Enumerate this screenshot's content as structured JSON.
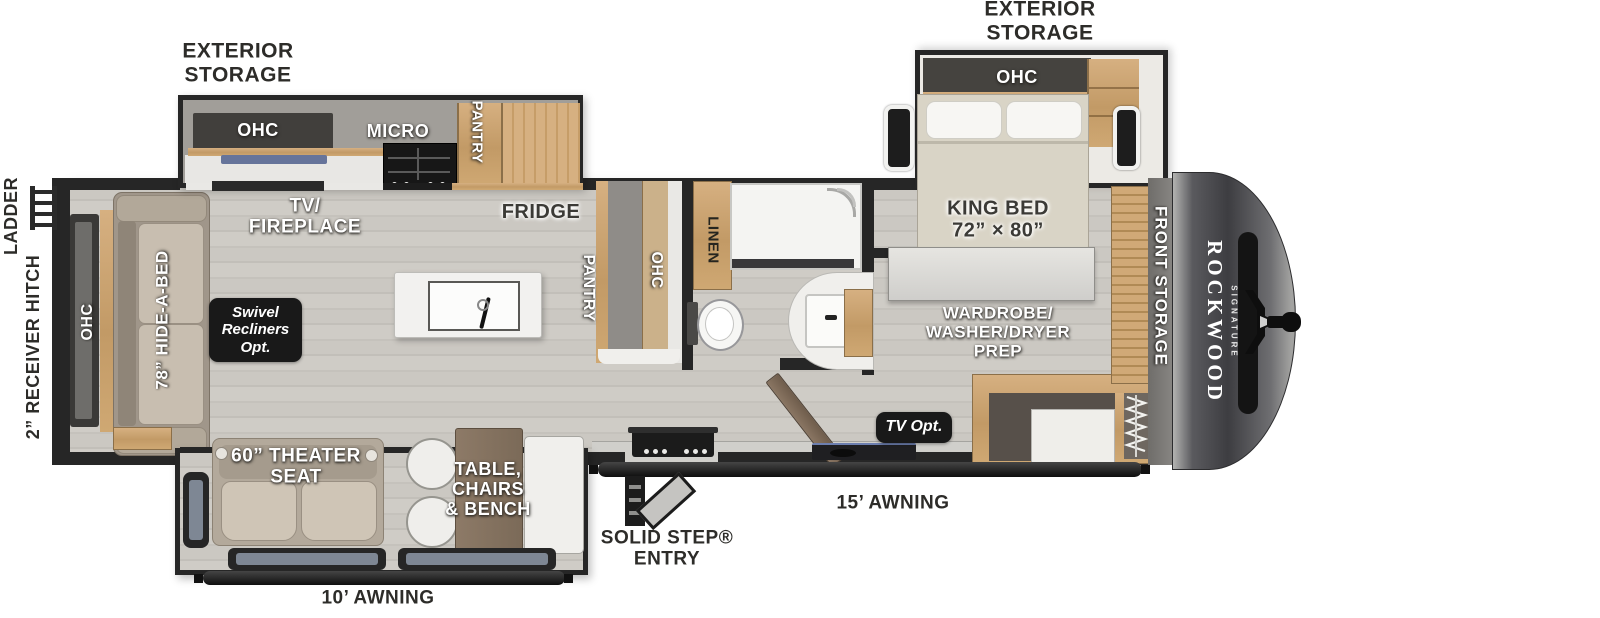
{
  "plan": {
    "brand": "ROCKWOOD",
    "series": "SIGNATURE"
  },
  "exterior_labels": {
    "storage_rear": "EXTERIOR\nSTORAGE",
    "storage_front": "EXTERIOR\nSTORAGE",
    "ladder": "LADDER",
    "receiver_hitch": "2” RECEIVER HITCH",
    "awning_rear": "10’ AWNING",
    "awning_main": "15’ AWNING",
    "entry": "SOLID STEP®\nENTRY",
    "front_storage": "FRONT STORAGE"
  },
  "living_area": {
    "rear_ohc": "OHC",
    "sofa": "78” HIDE-A-BED",
    "swivel_option": "Swivel\nRecliners\nOpt.",
    "tv_fireplace": "TV/\nFIREPLACE",
    "theater_seat": "60” THEATER\nSEAT",
    "dinette": "TABLE,\nCHAIRS\n& BENCH"
  },
  "kitchen": {
    "ohc": "OHC",
    "microwave": "MICRO",
    "pantry": "PANTRY",
    "fridge": "FRIDGE",
    "galley_pantry": "PANTRY",
    "galley_ohc": "OHC"
  },
  "bathroom": {
    "linen": "LINEN"
  },
  "bedroom": {
    "ohc": "OHC",
    "bed": "KING BED\n72” × 80”",
    "wardrobe": "WARDROBE/\nWASHER/DRYER\nPREP",
    "tv_option": "TV Opt."
  },
  "colors": {
    "wall": "#262626",
    "floor": "#c9c6c0",
    "wood": "#c9a272",
    "badge": "#191919"
  }
}
